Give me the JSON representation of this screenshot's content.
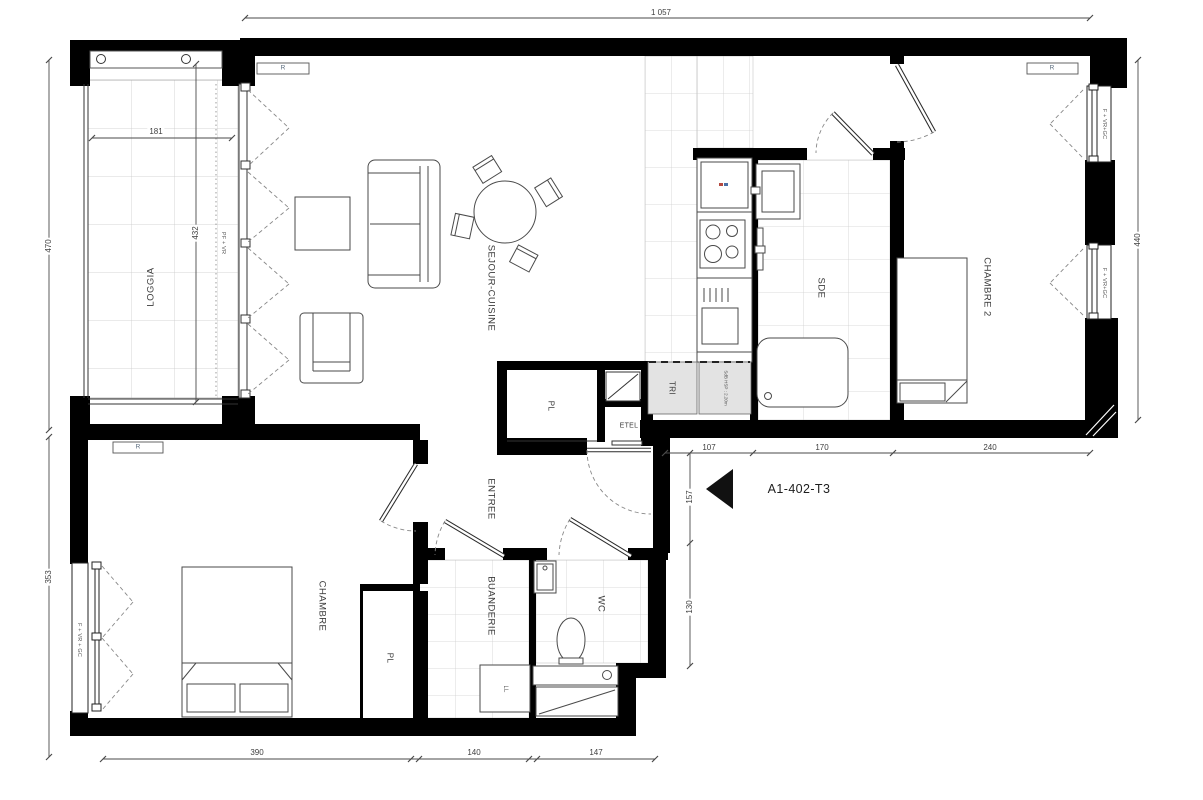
{
  "title": "A1-402-T3",
  "rooms": {
    "loggia": "LOGGIA",
    "sejour": "SEJOUR-CUISINE",
    "chambre2": "CHAMBRE 2",
    "sde": "SDE",
    "chambre": "CHAMBRE",
    "entree": "ENTREE",
    "buanderie": "BUANDERIE",
    "wc": "WC",
    "pl": "PL",
    "etel": "ETEL",
    "tri": "TRI"
  },
  "fixtures": {
    "radiator": "R",
    "washer": "LL",
    "duct_note": "SdB HSP : 2.20m"
  },
  "windows": {
    "loggia": "PF + VR",
    "chambre_left": "F + VR + GC",
    "chambre2_top": "F + VR+GC",
    "chambre2_bottom": "F + VR+GC"
  },
  "dims": {
    "top": "1 057",
    "left_upper": "470",
    "left_lower": "353",
    "right": "440",
    "loggia_w": "181",
    "loggia_h": "432",
    "mid1": "107",
    "mid2": "170",
    "mid3": "240",
    "v1": "157",
    "v2": "130",
    "bot1": "390",
    "bot2": "140",
    "bot3": "147"
  }
}
